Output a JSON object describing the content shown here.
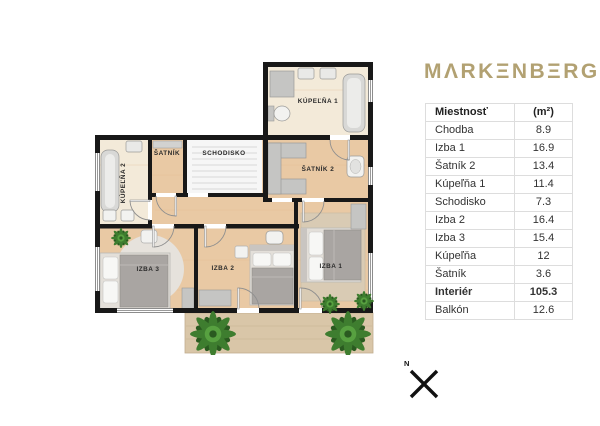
{
  "brand": {
    "logo_text": "MΛRKΞNBΞRG",
    "logo_color": "#b2a172"
  },
  "legend_table": {
    "header": {
      "room": "Miestnosť",
      "area": "(m²)"
    },
    "rows": [
      {
        "name": "Chodba",
        "area": "8.9"
      },
      {
        "name": "Izba 1",
        "area": "16.9"
      },
      {
        "name": "Šatník 2",
        "area": "13.4"
      },
      {
        "name": "Kúpeľňa 1",
        "area": "11.4"
      },
      {
        "name": "Schodisko",
        "area": "7.3"
      },
      {
        "name": "Izba 2",
        "area": "16.4"
      },
      {
        "name": "Izba 3",
        "area": "15.4"
      },
      {
        "name": "Kúpeľňa",
        "area": "12"
      },
      {
        "name": "Šatník",
        "area": "3.6"
      },
      {
        "name": "Interiér",
        "area": "105.3"
      },
      {
        "name": "Balkón",
        "area": "12.6"
      }
    ]
  },
  "floor_plan": {
    "labels": {
      "kupelna1": "KÚPEĽŇA 1",
      "kupelna2": "KÚPEĽŇA 2",
      "satnik": "ŠATNÍK",
      "schodisko": "SCHODISKO",
      "satnik2": "ŠATNÍK 2",
      "izba1": "IZBA 1",
      "izba2": "IZBA 2",
      "izba3": "IZBA 3"
    },
    "colors": {
      "wall": "#181818",
      "wood_floor": "#e9c9a4",
      "bath_floor": "#f3ead9",
      "stairs_floor": "#f6f6f6",
      "balcony_floor": "#d9c6a8",
      "furniture_gray": "#c5c5c3",
      "bed_gray": "#a9a5a2",
      "plant_green": "#3e7d2f"
    }
  },
  "compass": {
    "north_label": "N"
  }
}
